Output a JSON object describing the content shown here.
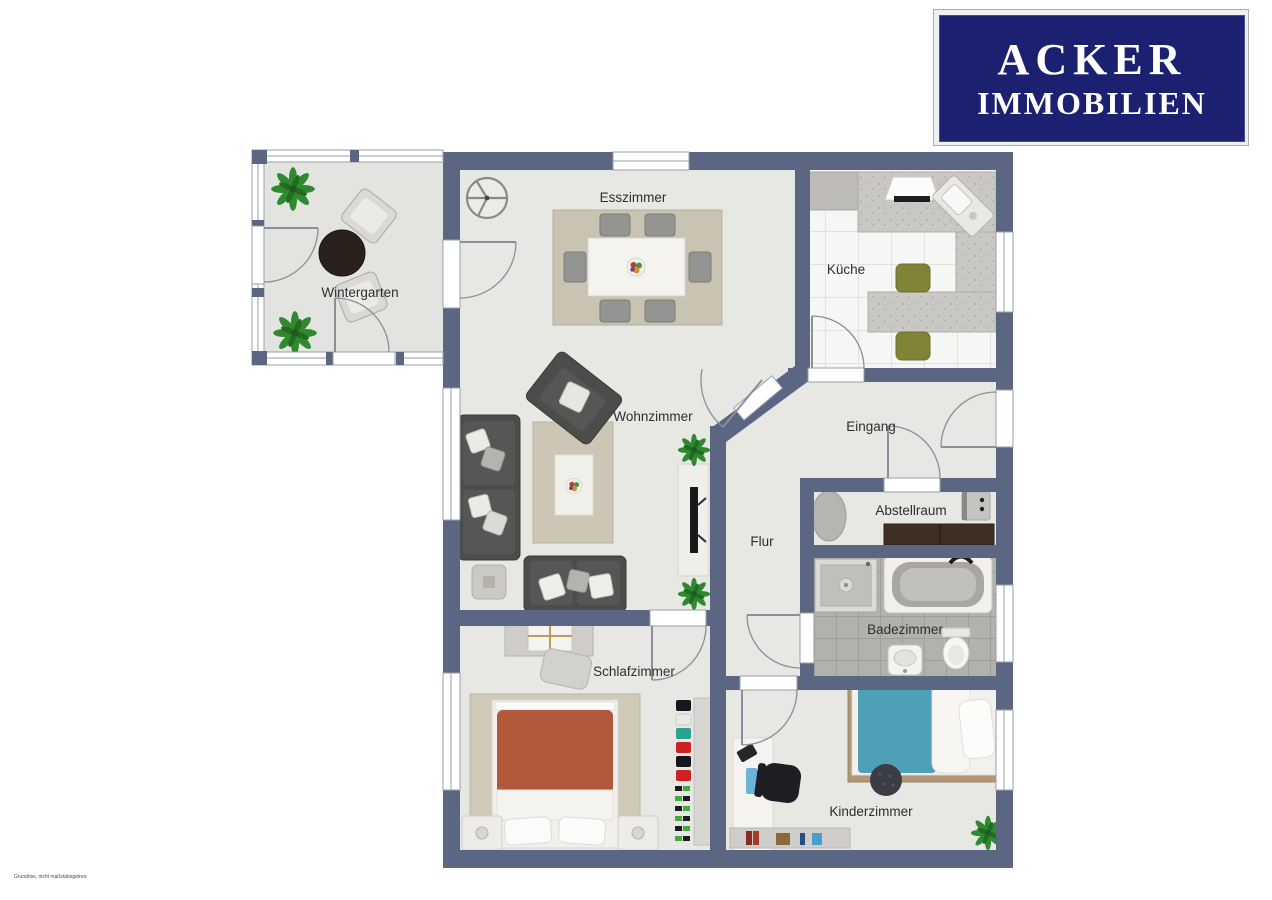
{
  "logo": {
    "line1": "ACKER",
    "line2": "IMMOBILIEN",
    "bg": "#1b2070",
    "text_color": "#ffffff"
  },
  "disclaimer": "Grundriss, nicht maßstabsgetreu",
  "plan": {
    "wall_color": "#5b6683",
    "floor_color": "#e7e7e4",
    "rooms": [
      {
        "id": "wintergarten",
        "label": "Wintergarten"
      },
      {
        "id": "esszimmer",
        "label": "Esszimmer"
      },
      {
        "id": "kueche",
        "label": "Küche"
      },
      {
        "id": "wohnzimmer",
        "label": "Wohnzimmer"
      },
      {
        "id": "eingang",
        "label": "Eingang"
      },
      {
        "id": "abstellraum",
        "label": "Abstellraum"
      },
      {
        "id": "flur",
        "label": "Flur"
      },
      {
        "id": "badezimmer",
        "label": "Badezimmer"
      },
      {
        "id": "schlafzimmer",
        "label": "Schlafzimmer"
      },
      {
        "id": "kinderzimmer",
        "label": "Kinderzimmer"
      }
    ]
  }
}
